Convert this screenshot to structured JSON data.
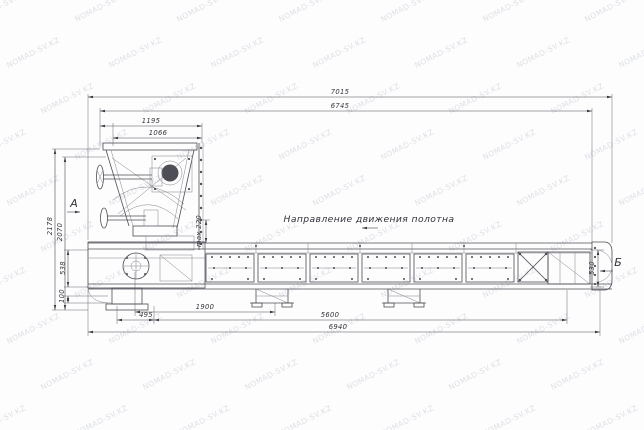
{
  "watermark": {
    "text": "NOMAD-SV.KZ",
    "color": "#aeb6c6"
  },
  "drawing": {
    "direction_label": "Направление движения полотна",
    "view_labels": {
      "a": "А",
      "b": "Б"
    },
    "dimensions": {
      "overall_length": "7015",
      "length_6745": "6745",
      "head_width": "1195",
      "head_inner_width": "1066",
      "height_left_outer": "2178",
      "height_left_inner": "2070",
      "max_gap": "max 220",
      "belt_height_left": "538",
      "foot_height": "100",
      "span_495": "495",
      "span_1900": "1900",
      "span_5600": "5600",
      "base_length": "6940",
      "belt_height_right": "530"
    },
    "line_color": "#4e4e57"
  }
}
